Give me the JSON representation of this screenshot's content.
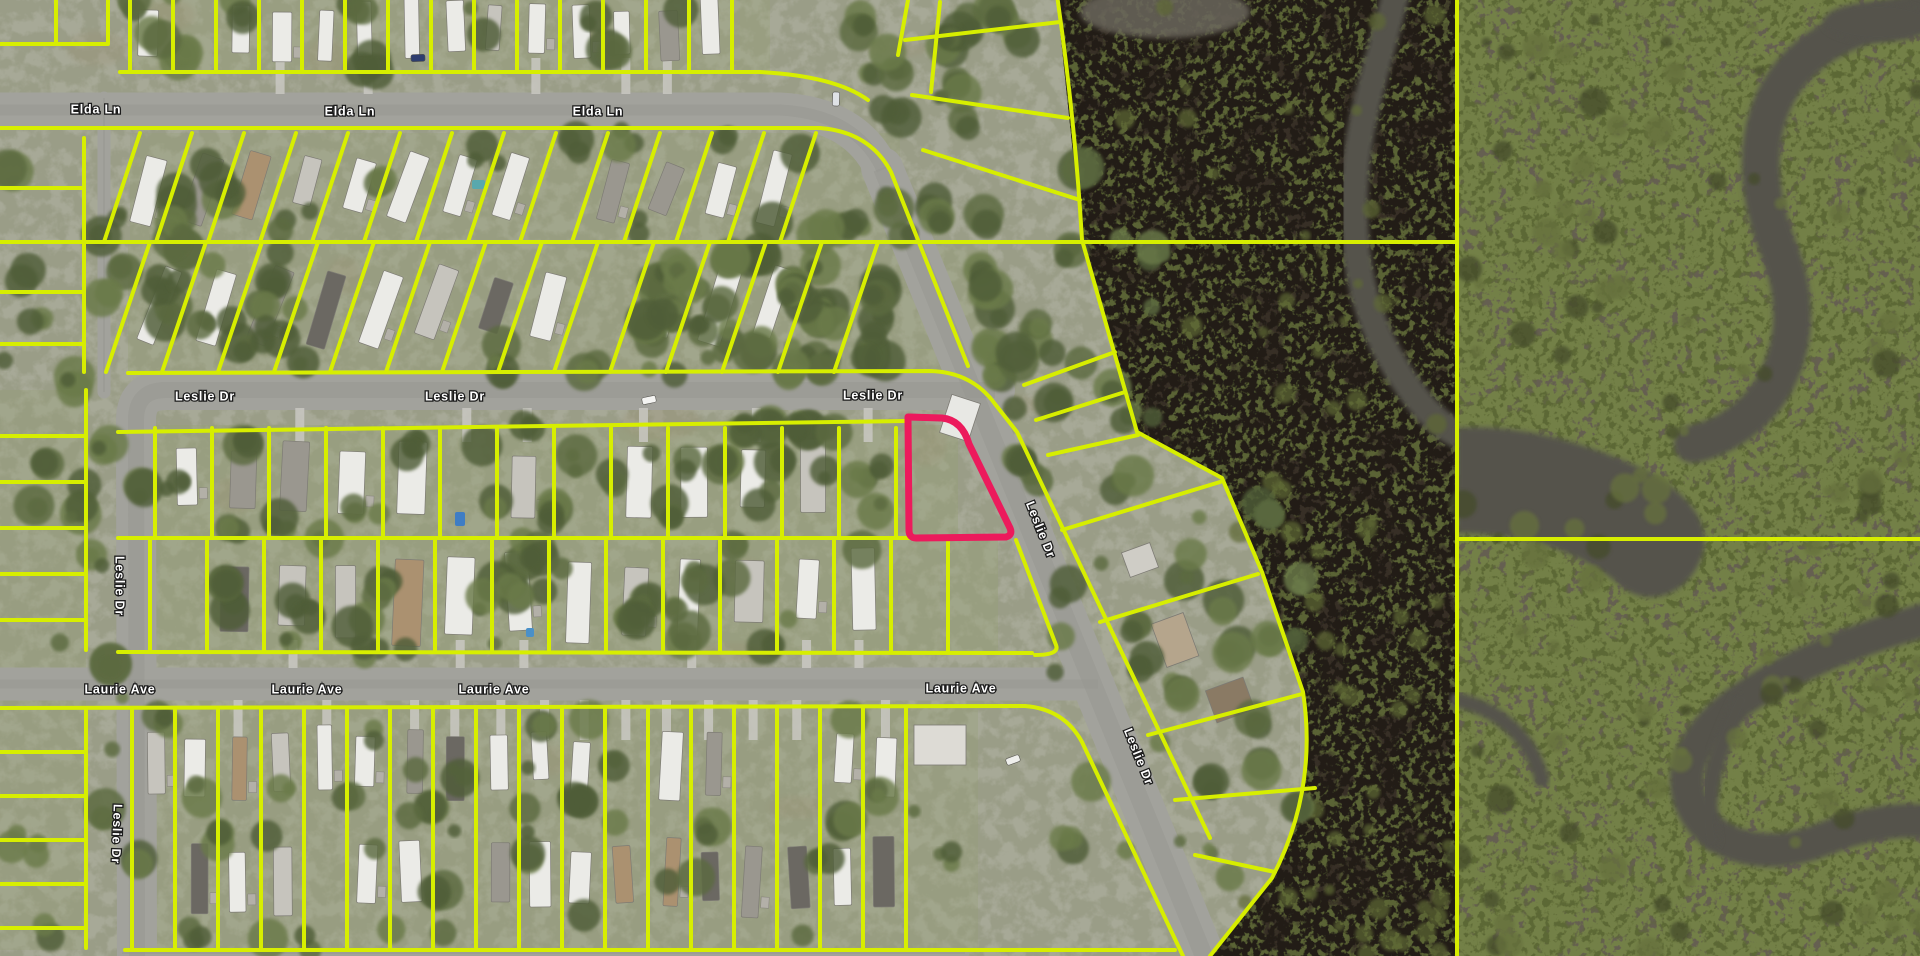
{
  "map": {
    "description": "Aerial parcel map of mobile-home community beside marsh preserve",
    "street_labels": [
      {
        "text": "Elda Ln",
        "x": 96,
        "y": 110,
        "rot": 0
      },
      {
        "text": "Elda Ln",
        "x": 350,
        "y": 112,
        "rot": 0
      },
      {
        "text": "Elda Ln",
        "x": 598,
        "y": 112,
        "rot": 0
      },
      {
        "text": "Leslie Dr",
        "x": 205,
        "y": 397,
        "rot": 0
      },
      {
        "text": "Leslie Dr",
        "x": 455,
        "y": 397,
        "rot": 0
      },
      {
        "text": "Leslie Dr",
        "x": 873,
        "y": 396,
        "rot": 0
      },
      {
        "text": "Leslie Dr",
        "x": 1040,
        "y": 530,
        "rot": 68
      },
      {
        "text": "Leslie Dr",
        "x": 1138,
        "y": 757,
        "rot": 68
      },
      {
        "text": "Leslie Dr",
        "x": 119,
        "y": 586,
        "rot": 90
      },
      {
        "text": "Leslie Dr",
        "x": 116,
        "y": 834,
        "rot": 92
      },
      {
        "text": "Laurie Ave",
        "x": 120,
        "y": 690,
        "rot": 0
      },
      {
        "text": "Laurie Ave",
        "x": 307,
        "y": 690,
        "rot": 0
      },
      {
        "text": "Laurie Ave",
        "x": 494,
        "y": 690,
        "rot": 0
      },
      {
        "text": "Laurie Ave",
        "x": 961,
        "y": 689,
        "rot": 0
      }
    ],
    "colors": {
      "parcel_line": "#d7ee00",
      "highlight": "#ec1a5c",
      "road": "#a2a29c",
      "ground": "#a7a997",
      "grass": "#96a073",
      "tree_dark": "#4f5d37",
      "tree_mid": "#5b6a3f",
      "tree_light": "#6b7a48",
      "marsh_base": "#372f26",
      "marsh_green": "#5a6434",
      "mangrove_base": "#655f51",
      "mangrove_green": "#5c6736",
      "water": "#55534b",
      "label_fill": "#ffffff",
      "label_halo": "#1c1c1c"
    },
    "highlighted_parcel": {
      "path": "M908,417 L942,418 Q962,420 969,444 L1010,528 Q1013,535 1006,537 L916,538 Q909,538 909,530 Z",
      "stroke_width": 7
    },
    "roads": [
      {
        "d": "M-10,110 L780,110 Q856,114 882,170",
        "w": 35
      },
      {
        "d": "M882,168 L1208,966",
        "w": 42
      },
      {
        "d": "M137,966 L136,420 Q136,390 166,390 L995,390",
        "w": 40
      },
      {
        "d": "M-10,684 L1098,684",
        "w": 33
      },
      {
        "d": "M104,98 L104,392",
        "w": 13
      },
      {
        "d": "M122,953 L965,953",
        "w": 9
      }
    ],
    "parcel_paths": [
      "M0,44 L108,44 M56,0 L56,44 M108,0 L108,44",
      "M120,72 L760,72 Q835,76 868,100",
      "M-10,128 L820,128 Q870,132 891,172 L968,366",
      "M-10,242 L1457,242",
      "M128,373 L930,371 Q972,372 995,404 L1017,432 L1210,838",
      "M118,432 L905,421",
      "M118,538 L958,538",
      "M1016,540 L1056,645 Q1060,655 1035,655",
      "M118,652 L1032,653",
      "M-10,708 L1025,706 Q1064,709 1082,742 L1183,956",
      "M125,950 L1175,950",
      "M86,390 L86,650 M86,708 L86,948 M84,138 L84,372",
      "M0,188 L84,188 M0,292 L84,292 M0,344 L84,344",
      "M0,436 L86,436 M0,482 L86,482 M0,528 L86,528 M0,574 L86,574 M0,620 L86,620",
      "M0,752 L86,752 M0,796 L86,796 M0,840 L86,840 M0,884 L86,884 M0,928 L86,928",
      "M908,0 L898,55 M940,2 L931,92",
      "M905,40 L1060,22 M912,95 L1068,118 M923,150 L1080,200",
      "M1057,-5 Q1075,120 1082,240 L1137,432 L1222,478 L1262,572 L1303,692 Q1318,790 1272,878 L1210,956",
      "M1024,385 L1115,352 M1036,420 L1125,392 M1048,455 L1138,435",
      "M1062,530 L1220,482 M1100,622 L1258,574 M1148,735 L1302,694 M1175,800 L1315,788 M1195,855 L1275,872",
      "M1457,-5 L1457,960",
      "M1457,539 L1925,539"
    ],
    "blocks": [
      {
        "x0": 130,
        "x1": 762,
        "yTop": -6,
        "yBot": 72,
        "step": 43,
        "skew": 0,
        "angle": 0,
        "houseW": 16,
        "houseL": 50,
        "rows": [
          30
        ],
        "drive": [
          58,
          94
        ]
      },
      {
        "x0": 140,
        "x1": 832,
        "yTop": 133,
        "yBot": 242,
        "step": 52,
        "skew": -36,
        "angle": 18,
        "houseW": 18,
        "houseL": 60,
        "rows": [
          186
        ],
        "drive": null
      },
      {
        "x0": 150,
        "x1": 932,
        "yTop": 242,
        "yBot": 372,
        "step": 56,
        "skew": -44,
        "angle": 18,
        "houseW": 19,
        "houseL": 64,
        "rows": [
          305
        ],
        "drive": null
      },
      {
        "x0": 155,
        "x1": 900,
        "yTop": 428,
        "yBot": 538,
        "step": 57,
        "skew": 0,
        "angle": 0,
        "houseW": 23,
        "houseL": 70,
        "rows": [
          482
        ],
        "drive": [
          408,
          442
        ]
      },
      {
        "x0": 150,
        "x1": 950,
        "yTop": 538,
        "yBot": 652,
        "step": 57,
        "skew": 0,
        "angle": 0,
        "houseW": 23,
        "houseL": 70,
        "rows": [
          596
        ],
        "drive": [
          640,
          668
        ]
      },
      {
        "x0": 132,
        "x1": 940,
        "yTop": 708,
        "yBot": 950,
        "step": 43,
        "skew": 0,
        "angle": 0,
        "houseW": 17,
        "houseL": 58,
        "rows": [
          762,
          876
        ],
        "drive": [
          700,
          740
        ]
      }
    ],
    "grass_bands": [
      [
        130,
        -5,
        640,
        77,
        0.28
      ],
      [
        130,
        133,
        770,
        109,
        0.3
      ],
      [
        128,
        242,
        860,
        130,
        0.3
      ],
      [
        118,
        425,
        840,
        113,
        0.35
      ],
      [
        118,
        538,
        880,
        114,
        0.35
      ],
      [
        118,
        708,
        860,
        242,
        0.3
      ],
      [
        0,
        390,
        86,
        560,
        0.3
      ]
    ],
    "marsh": {
      "outline": "M1057,0 L1082,240 L1137,432 L1222,478 L1262,572 L1303,692 Q1318,790 1272,878 L1210,956 L1457,956 L1457,0 Z",
      "river": {
        "d": "M1396,-8 C1378,70 1352,130 1354,215 C1356,300 1382,352 1415,396 C1436,423 1450,430 1457,434",
        "w": 28
      },
      "top_water": {
        "cx": 1165,
        "cy": 12,
        "rx": 85,
        "ry": 26
      },
      "speckle_zones": [
        [
          1090,
          0,
          360,
          240
        ],
        [
          1140,
          250,
          300,
          200
        ],
        [
          1230,
          460,
          215,
          250
        ],
        [
          1300,
          640,
          150,
          320
        ],
        [
          1230,
          880,
          215,
          74
        ]
      ]
    },
    "mangrove": {
      "x": 1457,
      "filled_channel": "M1457,428 C1505,424 1565,436 1622,460 C1682,484 1716,520 1701,559 C1686,597 1646,608 1621,586 C1601,568 1561,546 1521,539 C1499,535 1475,533 1457,533 Z",
      "channels": [
        {
          "d": "M1925,12 C1852,22 1801,47 1776,96 C1752,144 1759,200 1779,250 C1799,300 1796,350 1771,390 C1752,419 1722,438 1693,444",
          "w": 38
        },
        {
          "d": "M1925,620 C1851,641 1791,666 1741,700 C1691,735 1671,780 1701,820 C1726,852 1776,858 1821,840 C1861,824 1901,818 1925,822",
          "w": 34
        },
        {
          "d": "M1741,700 C1721,742 1701,790 1711,840",
          "w": 18
        },
        {
          "d": "M1457,700 C1502,710 1532,740 1542,780",
          "w": 15
        }
      ],
      "corner_blob": {
        "cx": 1878,
        "cy": 22,
        "rx": 55,
        "ry": 20
      }
    },
    "tree_zones": [
      [
        130,
        133,
        770,
        240,
        58
      ],
      [
        380,
        425,
        520,
        230,
        52
      ],
      [
        120,
        425,
        260,
        230,
        16
      ],
      [
        130,
        708,
        820,
        242,
        44
      ],
      [
        620,
        240,
        285,
        132,
        24
      ],
      [
        860,
        0,
        220,
        240,
        24
      ],
      [
        980,
        240,
        180,
        260,
        24
      ],
      [
        1060,
        500,
        240,
        400,
        30
      ],
      [
        0,
        135,
        120,
        815,
        24
      ],
      [
        130,
        -6,
        640,
        78,
        14
      ]
    ],
    "pools": [
      {
        "x": 472,
        "y": 180,
        "w": 13,
        "h": 9,
        "c": "#58a8ad"
      },
      {
        "x": 455,
        "y": 512,
        "w": 10,
        "h": 14,
        "c": "#3f7dc4"
      },
      {
        "x": 526,
        "y": 628,
        "w": 8,
        "h": 9,
        "c": "#4a90c8"
      }
    ],
    "cars": [
      {
        "x": 649,
        "y": 400,
        "rot": 78,
        "c": "#f4f4f2"
      },
      {
        "x": 836,
        "y": 99,
        "rot": 2,
        "c": "#dfe2e6"
      },
      {
        "x": 418,
        "y": 58,
        "rot": 88,
        "c": "#2e3d6e"
      },
      {
        "x": 1013,
        "y": 760,
        "rot": 70,
        "c": "#efefec"
      }
    ]
  }
}
